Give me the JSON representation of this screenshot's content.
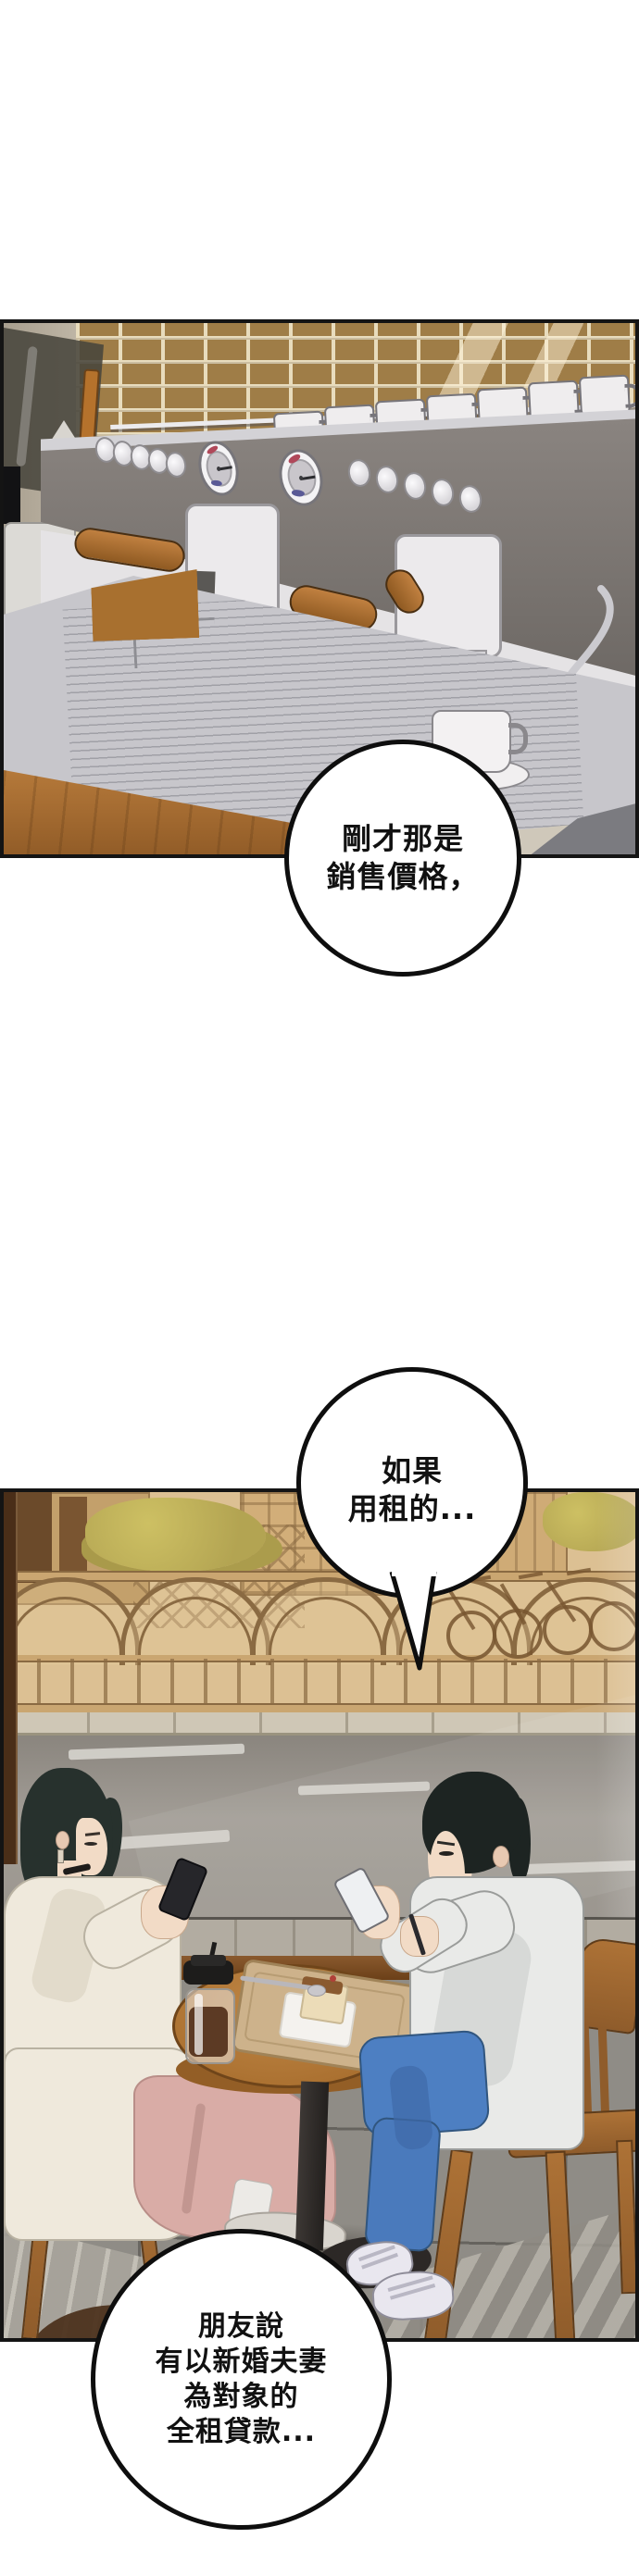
{
  "dialogue": {
    "bubble1": {
      "lines": [
        "剛才那是",
        "銷售價格，"
      ]
    },
    "bubble2": {
      "lines": [
        "如果",
        "用租的..."
      ]
    },
    "bubble3": {
      "lines": [
        "朋友說",
        "有以新婚夫妻",
        "為對象的",
        "全租貸款..."
      ]
    }
  },
  "palette": {
    "panel_border": "#141414",
    "bubble_fill": "#ffffff",
    "bubble_stroke": "#0e0e0e",
    "text": "#111111",
    "brick": "#9f7d47",
    "mortar": "#e8dcbd",
    "machine_gray": "#797370",
    "wood_counter": "#b5793a",
    "handle_wood": "#b5722c",
    "street_sepia": "#dcc093",
    "fence_line": "#8a6a42",
    "road_gray": "#9b968f",
    "floor_gray": "#8f8c86",
    "coat_cream": "#efe9dc",
    "skirt_pink": "#d9aca6",
    "jeans_blue": "#4d7fc2",
    "hair_dark": "#222c29",
    "table_wood": "#b9813f"
  }
}
